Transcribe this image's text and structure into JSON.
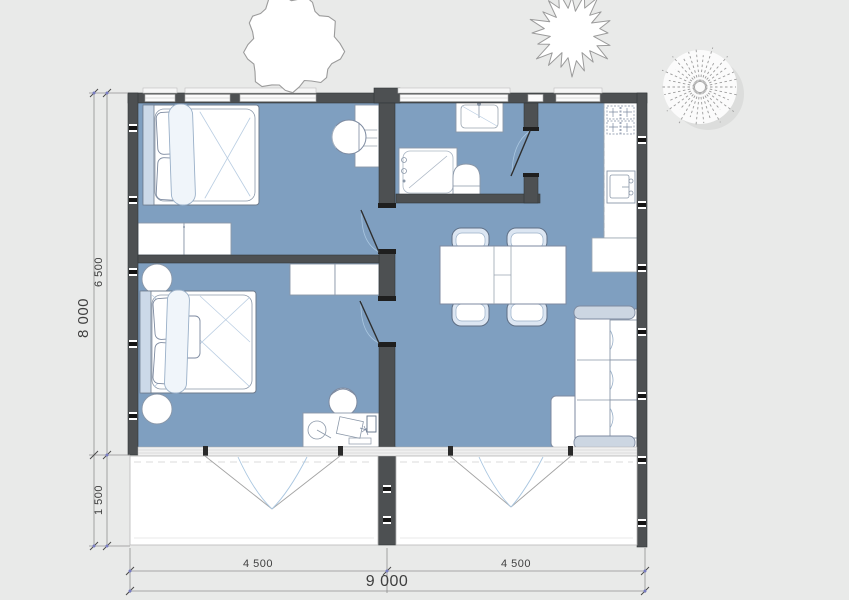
{
  "title": "house-floor-plan",
  "dimensions": {
    "total_height": "8 000",
    "indoor_depth": "6 500",
    "terrace_depth": "1 500",
    "bay_left": "4 500",
    "bay_right": "4 500",
    "total_width": "9 000"
  },
  "colors": {
    "background": "#e9eae9",
    "floor": "#7f9fc0",
    "wall": "#4d5052",
    "terrace": "#ffffff",
    "sketch_accent": "#aec6dd",
    "dimension_marker": "#777bc0",
    "dimension_text": "#3f3f3f"
  },
  "rooms": [
    {
      "id": "bedroom-1",
      "furniture": [
        "double-bed",
        "dresser",
        "dressing-table",
        "round-chair"
      ]
    },
    {
      "id": "bedroom-2",
      "furniture": [
        "double-bed",
        "wardrobe",
        "desk",
        "desk-chair",
        "stool",
        "plant"
      ]
    },
    {
      "id": "bathroom",
      "furniture": [
        "washbasin",
        "shower",
        "toilet"
      ]
    },
    {
      "id": "kitchen-living-room",
      "furniture": [
        "kitchen-counter",
        "cooktop",
        "kitchen-sink",
        "dining-table",
        "dining-chairs",
        "sofa"
      ]
    },
    {
      "id": "terrace-left",
      "furniture": []
    },
    {
      "id": "terrace-right",
      "furniture": []
    }
  ],
  "site": {
    "trees": [
      "round-tree",
      "spiky-tree",
      "feather-tree"
    ]
  }
}
